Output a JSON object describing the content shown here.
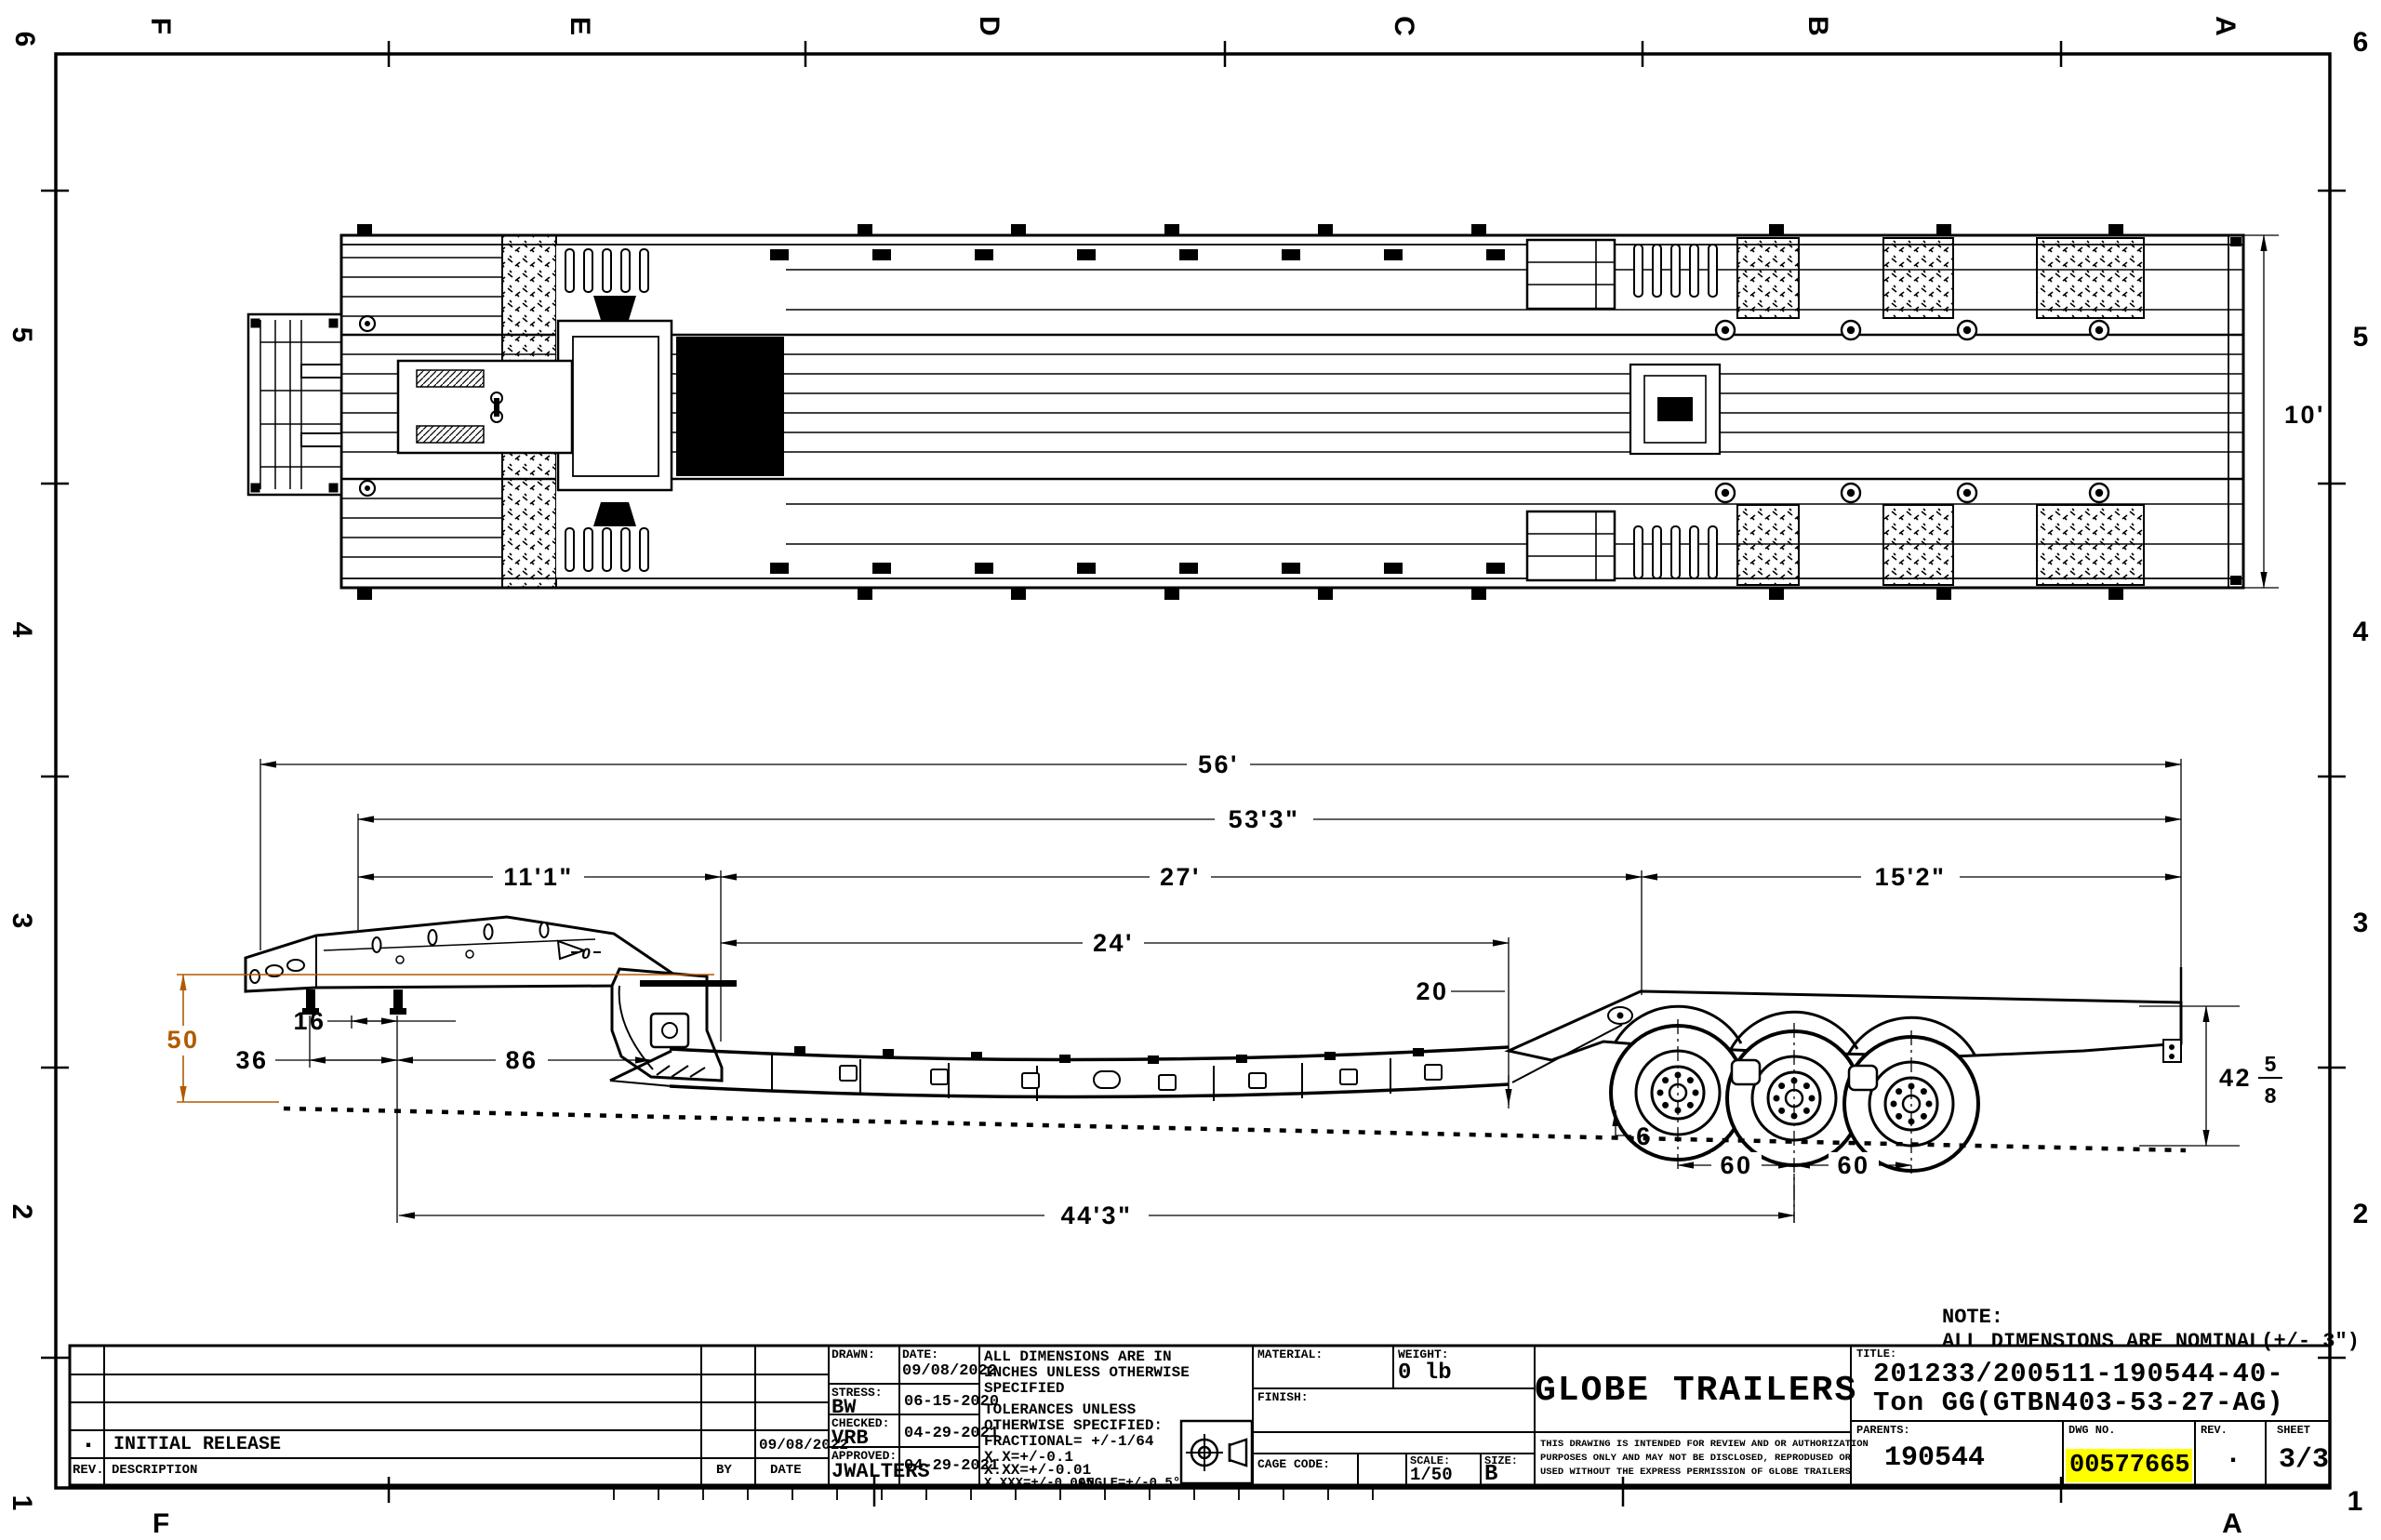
{
  "zones": {
    "top_letters": [
      "F",
      "E",
      "D",
      "C",
      "B",
      "A"
    ],
    "bottom_letters": [
      "F",
      "A"
    ],
    "left_numbers": [
      "6",
      "5",
      "4",
      "3",
      "2",
      "1"
    ],
    "right_numbers": [
      "6",
      "5",
      "4",
      "3",
      "2",
      "1"
    ]
  },
  "note": {
    "line1": "NOTE:",
    "line2": "ALL DIMENSIONS ARE NOMINAL(+/- 3\")"
  },
  "dimensions": {
    "overall_length": "56'",
    "length_53_3": "53'3\"",
    "front_11_1": "11'1\"",
    "mid_27": "27'",
    "rear_15_2": "15'2\"",
    "deck_24": "24'",
    "deck_20": "20",
    "kingpin_16": "16",
    "front_36": "36",
    "neck_86": "86",
    "deck_height_50": "50",
    "clearance_6": "6",
    "axle_60_a": "60",
    "axle_60_b": "60",
    "length_44_3": "44'3\"",
    "ride_whole": "42",
    "ride_num": "5",
    "ride_den": "8",
    "deck_width_10": "10'",
    "weld_mark": "0"
  },
  "colors": {
    "dim_accent": "#b25900",
    "dwg_no_highlight": "#ffff00",
    "line": "#000000",
    "paper": "#ffffff"
  },
  "title_block": {
    "revision_table": {
      "header_rev": "REV.",
      "header_description": "DESCRIPTION",
      "header_by": "BY",
      "header_date": "DATE",
      "row_rev": ".",
      "row_description": "INITIAL RELEASE",
      "row_by": "",
      "row_date": "09/08/2022"
    },
    "signoff": {
      "drawn_label": "DRAWN:",
      "drawn_date_label": "DATE:",
      "drawn_date": "09/08/2022",
      "stress_label": "STRESS:",
      "stress_name": "BW",
      "stress_date": "06-15-2020",
      "checked_label": "CHECKED:",
      "checked_name": "VRB",
      "checked_date": "04-29-2021",
      "approved_label": "APPROVED:",
      "approved_name": "JWALTERS",
      "approved_date": "04-29-2021"
    },
    "tolerances": {
      "lines": [
        "ALL DIMENSIONS ARE IN",
        "INCHES UNLESS OTHERWISE",
        "SPECIFIED",
        "TOLERANCES UNLESS",
        "OTHERWISE SPECIFIED:",
        "FRACTIONAL= +/-1/64",
        "X.X=+/-0.1",
        "X.XX=+/-0.01",
        "X.XXX=+/-0.005",
        "ANGLE=+/-0.5°"
      ]
    },
    "material": {
      "material_label": "MATERIAL:",
      "weight_label": "WEIGHT:",
      "weight_value": "0 lb",
      "finish_label": "FINISH:",
      "cage_code_label": "CAGE CODE:",
      "scale_label": "SCALE:",
      "scale_value": "1/50",
      "size_label": "SIZE:",
      "size_value": "B"
    },
    "company": {
      "name": "GLOBE TRAILERS",
      "disclaimer_line1": "THIS DRAWING IS INTENDED FOR REVIEW AND OR AUTHORIZATION",
      "disclaimer_line2": "PURPOSES ONLY AND MAY NOT BE DISCLOSED, REPRODUSED OR",
      "disclaimer_line3": "USED WITHOUT THE EXPRESS PERMISSION OF GLOBE TRAILERS"
    },
    "title": {
      "label": "TITLE:",
      "line1": "201233/200511-190544-40-",
      "line2": "Ton GG(GTBN403-53-27-AG)"
    },
    "parents_label": "PARENTS:",
    "parents_value": "190544",
    "dwg_no_label": "DWG NO.",
    "dwg_no_value": "00577665",
    "rev_label": "REV.",
    "rev_value": ".",
    "sheet_label": "SHEET",
    "sheet_value": "3/3"
  }
}
